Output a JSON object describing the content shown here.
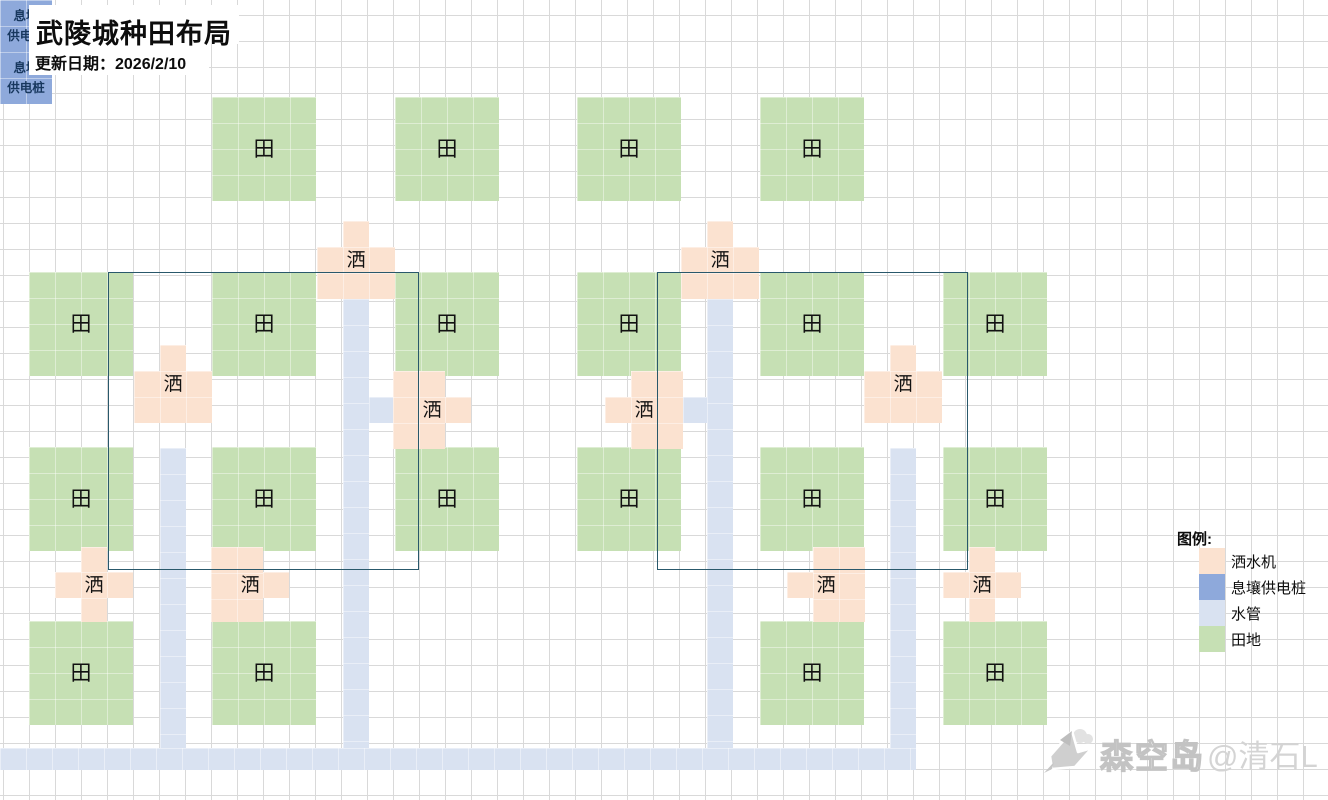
{
  "title": "武陵城种田布局",
  "update_date": "更新日期：2026/2/10",
  "legend": {
    "heading": "图例:",
    "items": [
      {
        "label": "洒水机",
        "color": "#fbe2d0"
      },
      {
        "label": "息壤供电桩",
        "color": "#8ea9db"
      },
      {
        "label": "水管",
        "color": "#d9e2f1"
      },
      {
        "label": "田地",
        "color": "#c6e0b4"
      }
    ]
  },
  "watermark": {
    "brand": "森空岛",
    "author": "@清石L"
  },
  "labels": {
    "field": "田",
    "sprinkler": "洒",
    "pile_line1": "息壤",
    "pile_line2": "供电桩"
  },
  "colors": {
    "field_green": "#c6e0b4",
    "sprinkler_peach": "#fbe2d0",
    "pipe_blue": "#d9e2f1",
    "pile_blue": "#8ea9db",
    "group_outline": "#29586b",
    "gridline": "#d9d9d9"
  },
  "layout": {
    "cell_size": 26,
    "grid_origin": [
      3,
      15
    ],
    "fields": [
      {
        "x": 212,
        "y": 97
      },
      {
        "x": 395,
        "y": 97
      },
      {
        "x": 29,
        "y": 272
      },
      {
        "x": 212,
        "y": 272
      },
      {
        "x": 395,
        "y": 272
      },
      {
        "x": 29,
        "y": 447
      },
      {
        "x": 212,
        "y": 447
      },
      {
        "x": 395,
        "y": 447
      },
      {
        "x": 29,
        "y": 621
      },
      {
        "x": 212,
        "y": 621
      },
      {
        "x": 577,
        "y": 97
      },
      {
        "x": 760,
        "y": 97
      },
      {
        "x": 577,
        "y": 272
      },
      {
        "x": 760,
        "y": 272
      },
      {
        "x": 943,
        "y": 272
      },
      {
        "x": 577,
        "y": 447
      },
      {
        "x": 760,
        "y": 447
      },
      {
        "x": 943,
        "y": 447
      },
      {
        "x": 760,
        "y": 621
      },
      {
        "x": 943,
        "y": 621
      }
    ],
    "field_size": 104,
    "sprinklers": [
      {
        "rects": [
          [
            343,
            221,
            26,
            26
          ],
          [
            317,
            247,
            78,
            52
          ]
        ],
        "label_cell": [
          343,
          247
        ]
      },
      {
        "rects": [
          [
            160,
            345,
            26,
            26
          ],
          [
            134,
            371,
            78,
            52
          ]
        ],
        "label_cell": [
          160,
          371
        ]
      },
      {
        "rects": [
          [
            393,
            371,
            52,
            78
          ],
          [
            445,
            397,
            26,
            26
          ]
        ],
        "label_cell": [
          419,
          397
        ]
      },
      {
        "rects": [
          [
            81,
            547,
            26,
            25
          ],
          [
            55,
            572,
            78,
            26
          ],
          [
            81,
            598,
            26,
            24
          ]
        ],
        "label_cell": [
          81,
          572
        ]
      },
      {
        "rects": [
          [
            211,
            547,
            52,
            75
          ],
          [
            263,
            572,
            26,
            26
          ]
        ],
        "label_cell": [
          237,
          572
        ]
      },
      {
        "rects": [
          [
            707,
            221,
            26,
            26
          ],
          [
            681,
            247,
            78,
            52
          ]
        ],
        "label_cell": [
          707,
          247
        ]
      },
      {
        "rects": [
          [
            890,
            345,
            26,
            26
          ],
          [
            864,
            371,
            78,
            52
          ]
        ],
        "label_cell": [
          890,
          371
        ]
      },
      {
        "rects": [
          [
            631,
            371,
            52,
            78
          ],
          [
            605,
            397,
            26,
            26
          ]
        ],
        "label_cell": [
          631,
          397
        ]
      },
      {
        "rects": [
          [
            969,
            547,
            26,
            25
          ],
          [
            943,
            572,
            78,
            26
          ],
          [
            969,
            598,
            26,
            24
          ]
        ],
        "label_cell": [
          969,
          572
        ]
      },
      {
        "rects": [
          [
            813,
            547,
            52,
            75
          ],
          [
            787,
            572,
            26,
            26
          ]
        ],
        "label_cell": [
          813,
          572
        ]
      }
    ],
    "piles": [
      {
        "x": 239,
        "y": 394,
        "w": 52,
        "h": 52
      },
      {
        "x": 785,
        "y": 394,
        "w": 52,
        "h": 52
      }
    ],
    "pipes": [
      [
        343,
        299,
        26,
        471
      ],
      [
        707,
        299,
        26,
        471
      ],
      [
        160,
        448,
        26,
        322
      ],
      [
        890,
        448,
        26,
        322
      ],
      [
        369,
        397,
        24,
        26
      ],
      [
        683,
        397,
        24,
        26
      ],
      [
        0,
        748,
        916,
        22
      ]
    ],
    "group_outlines": [
      [
        108,
        272,
        311,
        298
      ],
      [
        657,
        272,
        311,
        298
      ]
    ]
  }
}
